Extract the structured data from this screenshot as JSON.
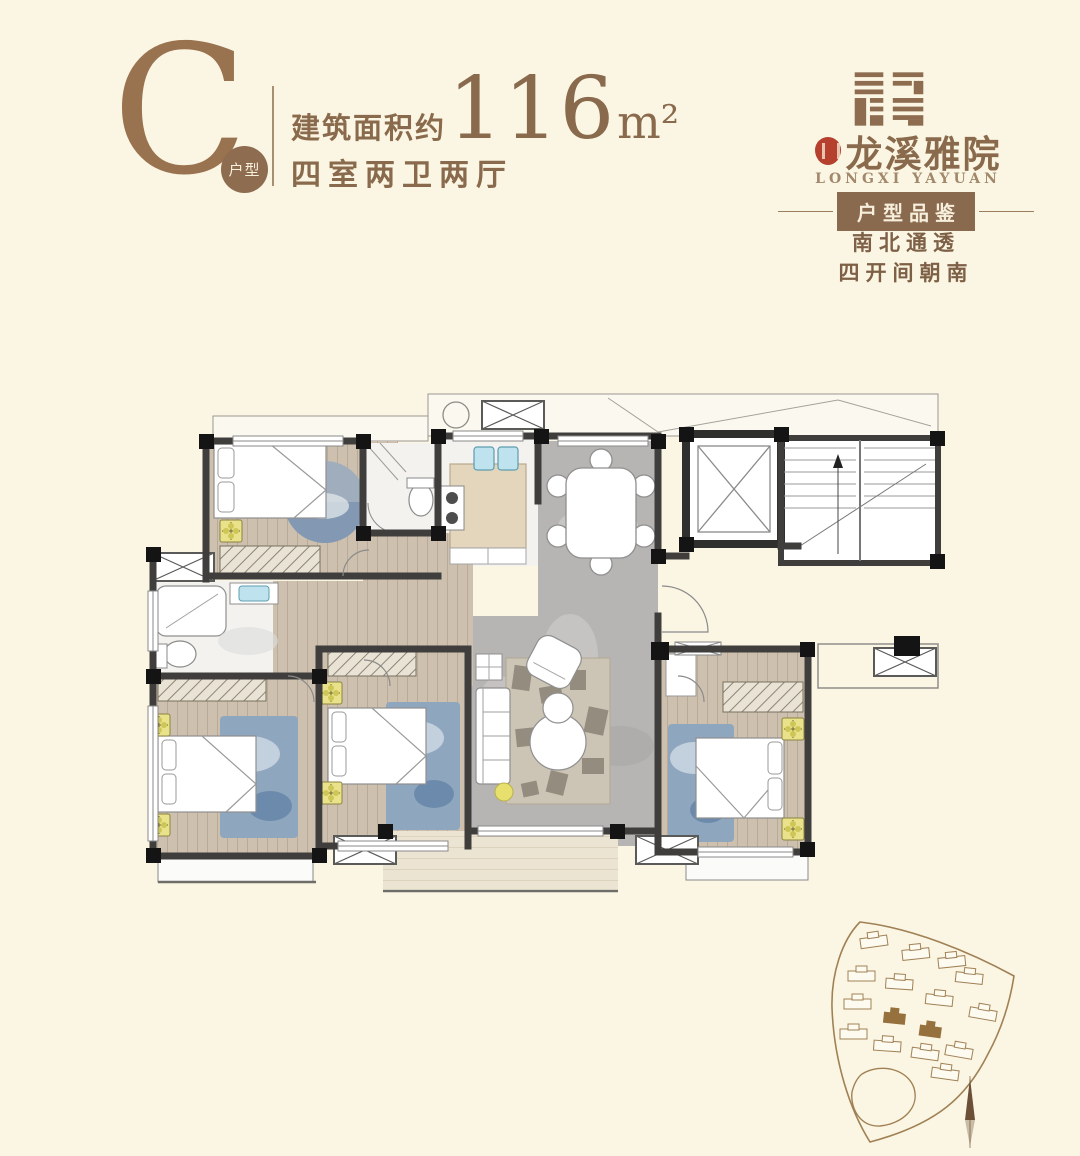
{
  "page": {
    "background": "#fbf6e3"
  },
  "palette": {
    "brand_brown": "#8d6c4f",
    "text_brown": "#8a6a4c",
    "deep_brown": "#7e6046",
    "badge_bg": "#8a6a4e",
    "badge_text": "#f6efdc",
    "seal_red": "#b5402e",
    "wall_dark": "#3f3e3c",
    "marble_gray": "#b7b5b3",
    "wood_tan": "#cdc0ae",
    "rug_blue": "#8fa6bf",
    "floret_yellow": "#eae28a",
    "sink_blue": "#bfe3ee"
  },
  "header": {
    "unit_letter": "C",
    "unit_badge_label": "户型",
    "area_prefix": "建筑面积约",
    "area_value": "116",
    "area_unit": "m²",
    "layout_text": "四室两卫两厅"
  },
  "brand": {
    "name": "龙溪雅院",
    "latin_name": "LONGXI YAYUAN",
    "section_badge": "户型品鉴",
    "selling_point_1": "南北通透",
    "selling_point_2": "四开间朝南"
  }
}
